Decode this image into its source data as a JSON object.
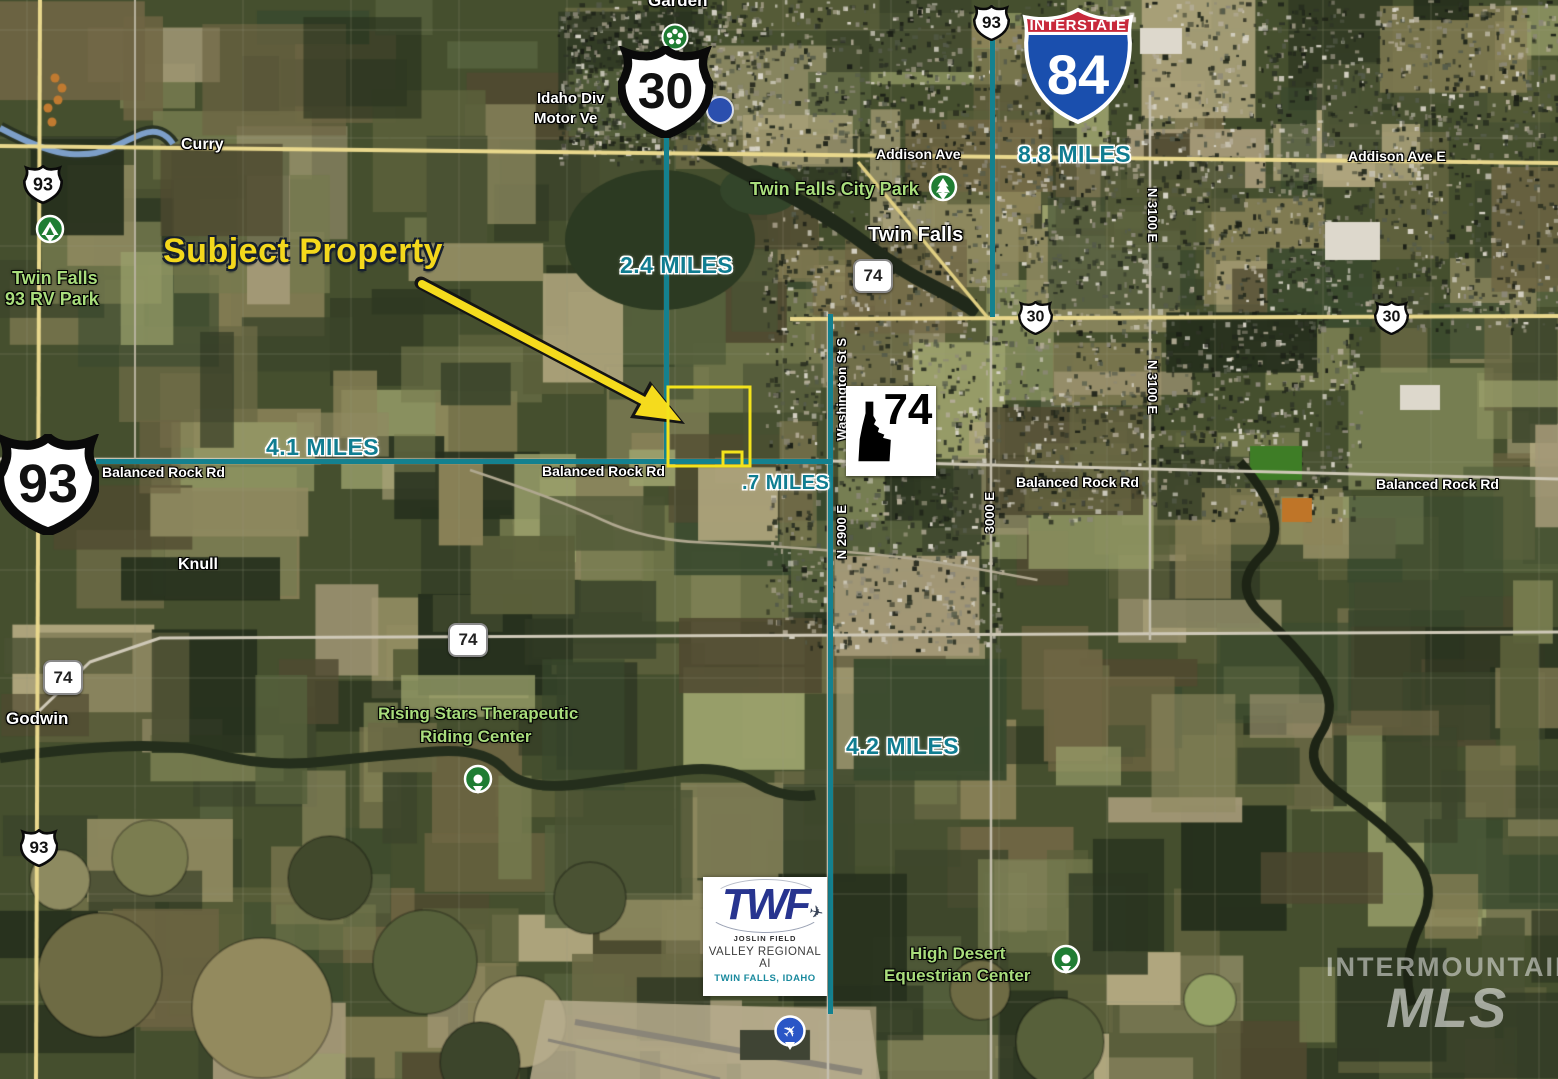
{
  "annotations": {
    "subject_property": "Subject Property",
    "distances": {
      "to_us30": "2.4 MILES",
      "to_i84": "8.8 MILES",
      "to_us93": "4.1 MILES",
      "to_washington": ".7 MILES",
      "to_airport": "4.2 MILES"
    }
  },
  "shields": {
    "us30_main": "30",
    "us30_jct_a": "30",
    "us30_jct_b": "30",
    "us93_top": "93",
    "us93_nw": "93",
    "us93_main": "93",
    "us93_sw": "93",
    "i84_banner": "INTERSTATE",
    "i84_number": "84",
    "sr74_city": "74",
    "sr74_mid": "74",
    "sr74_sw": "74",
    "idaho74": "74"
  },
  "roads": {
    "addison_ave": "Addison Ave",
    "addison_ave_e": "Addison Ave E",
    "balanced_rock_1": "Balanced Rock Rd",
    "balanced_rock_2": "Balanced Rock Rd",
    "balanced_rock_3": "Balanced Rock Rd",
    "balanced_rock_4": "Balanced Rock Rd",
    "n3100e_1": "N 3100 E",
    "n3100e_2": "N 3100 E",
    "e3000": "3000 E",
    "washington_st": "Washington St S",
    "n2900e": "N 2900 E"
  },
  "places": {
    "garden": "Garden",
    "curry": "Curry",
    "knull": "Knull",
    "godwin": "Godwin",
    "twin_falls": "Twin Falls",
    "dmv_line1": "Idaho Div",
    "dmv_line2": "Motor Ve",
    "city_park": "Twin Falls City Park",
    "rv_park_1": "Twin Falls",
    "rv_park_2": "93 RV Park",
    "rising_stars_1": "Rising Stars Therapeutic",
    "rising_stars_2": "Riding Center",
    "equestrian_1": "High Desert",
    "equestrian_2": "Equestrian Center"
  },
  "airport_logo": {
    "brand": "TWF",
    "subtitle1": "JOSLIN FIELD",
    "subtitle2": "VALLEY REGIONAL AI",
    "subtitle3": "TWIN FALLS, IDAHO"
  },
  "watermark": {
    "line1": "INTERMOUNTAIN",
    "line2": "MLS"
  },
  "colors": {
    "distance_text": "#107d91",
    "measure_line": "#14818f",
    "subject_yellow": "#f4d81c",
    "place_green": "#a9dd7c"
  }
}
